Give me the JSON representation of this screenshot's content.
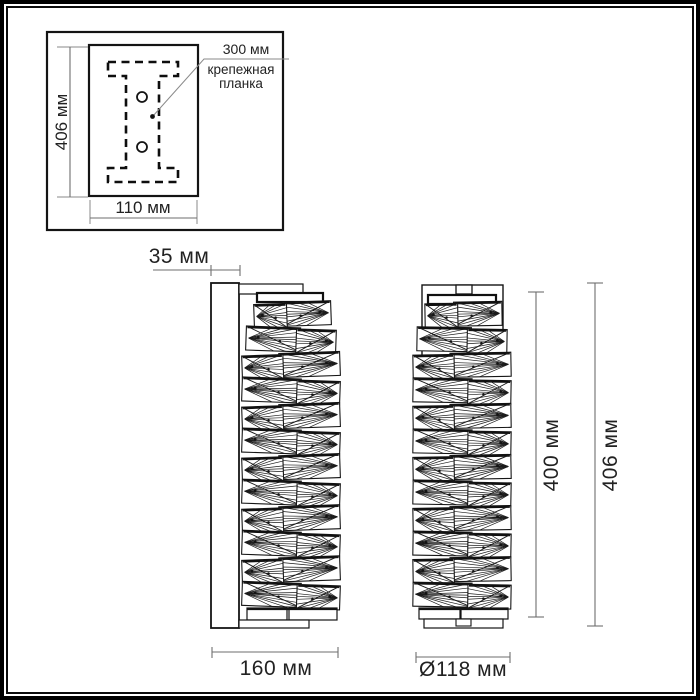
{
  "inset": {
    "height": "406 мм",
    "width": "110 мм",
    "callout_value": "300 мм",
    "callout_line1": "крепежная",
    "callout_line2": "планка"
  },
  "side_view": {
    "depth": "35 мм",
    "width": "160 мм"
  },
  "front_view": {
    "diameter": "Ø118 мм",
    "lamp_height": "400 мм",
    "total_height": "406 мм"
  },
  "colors": {
    "line": "#141414",
    "dimension": "#6e6e6e",
    "text": "#222222",
    "background": "#ffffff"
  }
}
